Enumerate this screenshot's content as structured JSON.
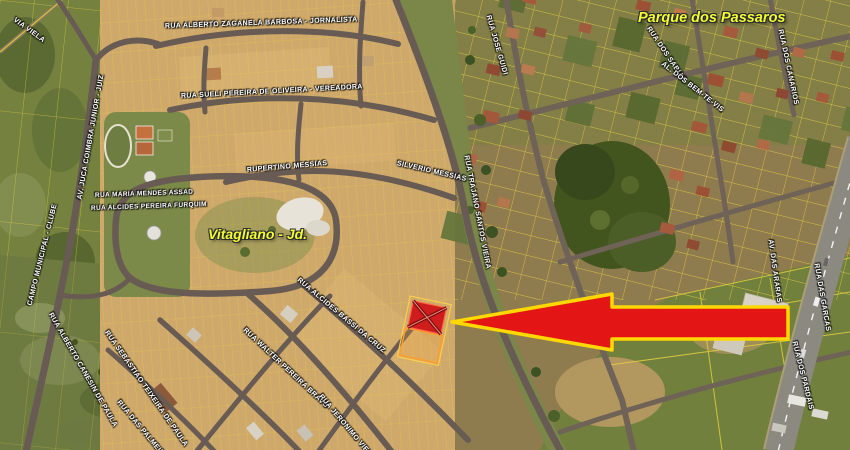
{
  "map": {
    "place_labels": [
      {
        "text": "Vitagliano - Jd."
      },
      {
        "text": "Parque dos Passaros"
      }
    ],
    "street_labels": [
      {
        "text": "VIA VIELA"
      },
      {
        "text": "RUA ALBERTO ZAGANELA BARBOSA - JORNALISTA"
      },
      {
        "text": "RUA SUELI PEREIRA DE OLIVEIRA - VEREADORA"
      },
      {
        "text": "RUPERTINO MESSIAS"
      },
      {
        "text": "SILVERIO MESSIAS"
      },
      {
        "text": "RUA TRAJANO SANTOS VIEIRA"
      },
      {
        "text": "RUA MARIA MENDES ASSAD"
      },
      {
        "text": "RUA ALCIDES PEREIRA FURQUIM"
      },
      {
        "text": "AV. JUCA COIMBRA JUNIOR - JUIZ"
      },
      {
        "text": "CAMPO MUNICIPAL - CLUBE"
      },
      {
        "text": "RUA ALBERTO CANESIN DE PAULA"
      },
      {
        "text": "RUA SEBASTIAO TEIXEIRA DE PAULA"
      },
      {
        "text": "RUA ALCIDES BASSI DA CRUZ"
      },
      {
        "text": "RUA WALTER PEREIRA BRAVO"
      },
      {
        "text": "RUA DAS PALMEIRAS"
      },
      {
        "text": "RUA JERONIMO VIEIRA"
      },
      {
        "text": "RUA JOSE GUIDI"
      },
      {
        "text": "RUA DOS SABIAS"
      },
      {
        "text": "AL. DOS BEM-TE-VIS"
      },
      {
        "text": "RUA DOS CANARIOS"
      },
      {
        "text": "AV. DAS ARARAS"
      },
      {
        "text": "RUA DAS GARCAS"
      },
      {
        "text": "RUA DOS PARDAIS"
      }
    ],
    "marker": {
      "type": "highlighted-lot-with-arrow"
    }
  },
  "colors": {
    "arrow_fill": "#e31515",
    "arrow_outline": "#ffd800",
    "lot_marker": "#cf1d1d",
    "parcel_line": "#e8d33f",
    "place_label": "#f4ff2d",
    "street_label": "#ffffff"
  }
}
